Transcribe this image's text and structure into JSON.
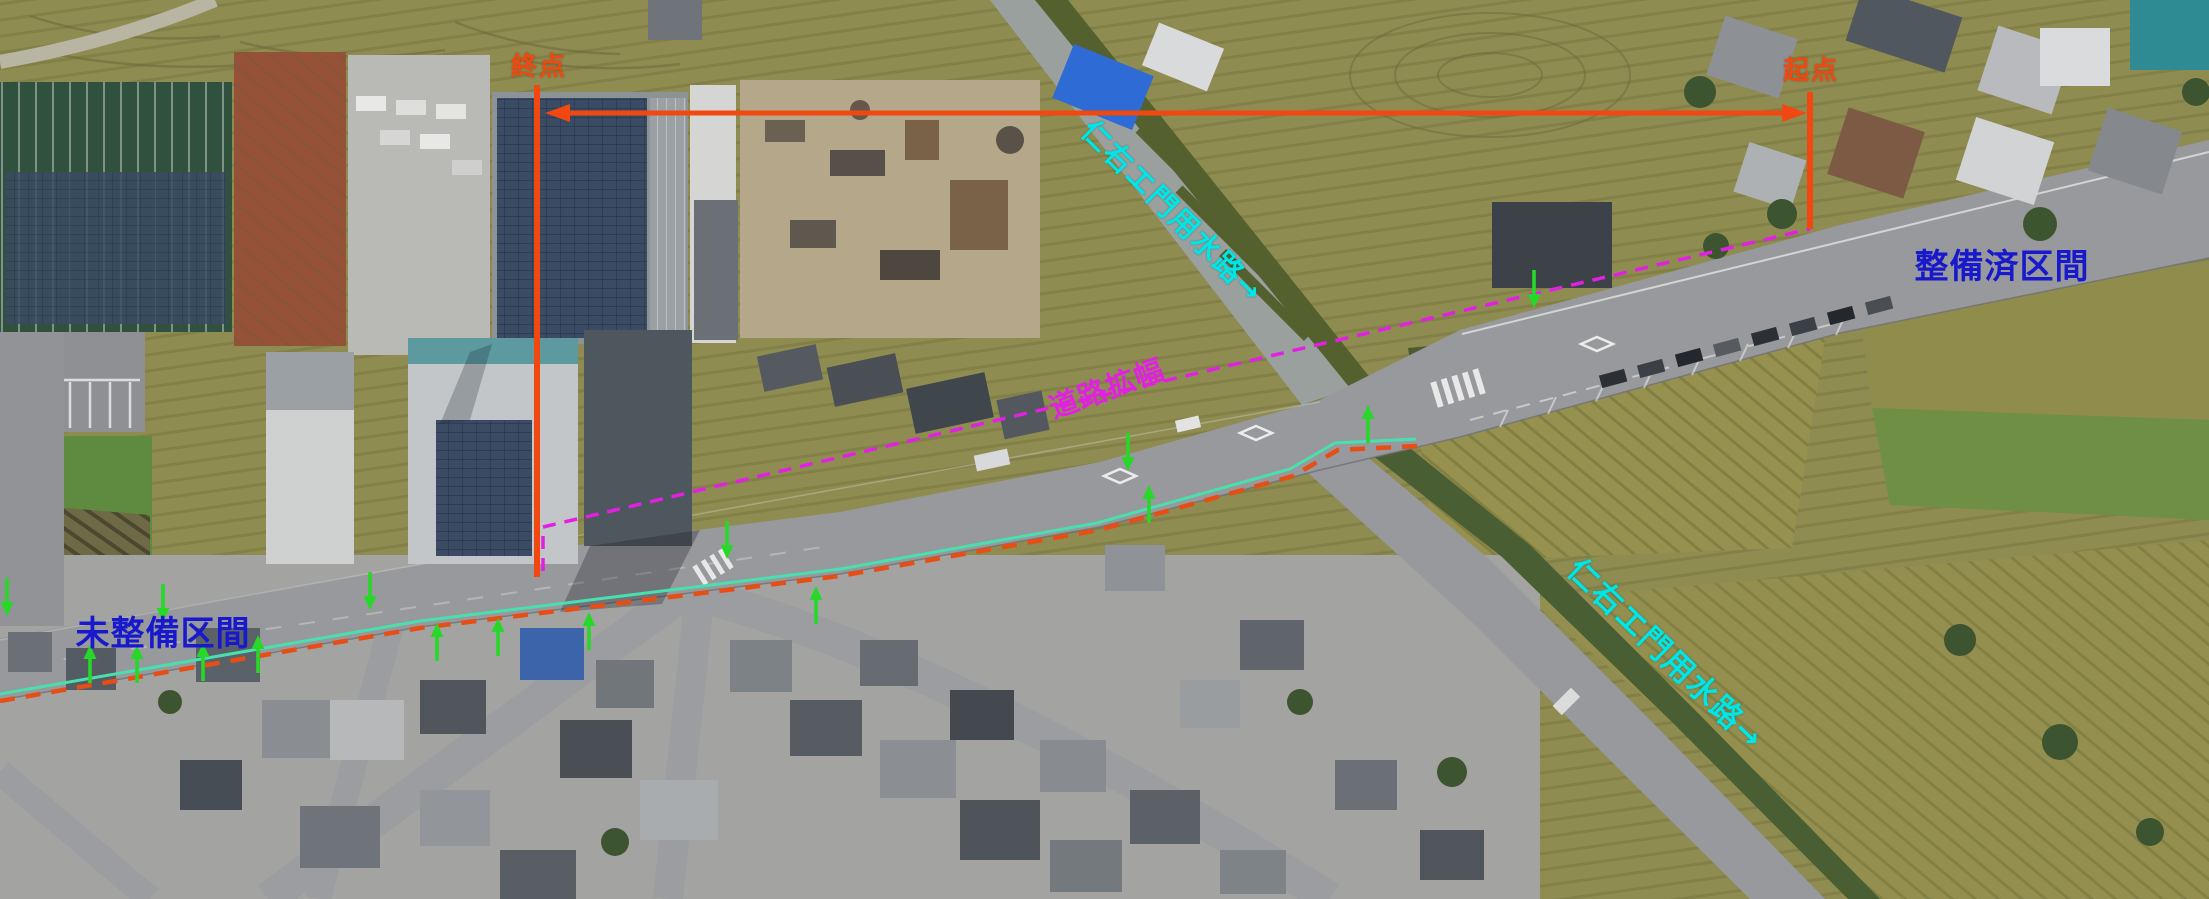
{
  "canvas": {
    "width": 2209,
    "height": 899
  },
  "annotations": {
    "end_point_label": "終点",
    "start_point_label": "起点",
    "upper_waterway_label": "仁右エ門用水路→",
    "lower_waterway_label": "仁右エ門用水路→",
    "improved_section_label": "整備済区間",
    "unimproved_section_label": "未整備区間",
    "road_widening_label": "道路拡幅"
  },
  "colors": {
    "section_marker_orange": "#f04810",
    "widening_magenta": "#e220e2",
    "waterway_cyan": "#00e6e6",
    "section_text_blue": "#1818cc",
    "arrow_green": "#28d828",
    "boundary_teal": "#4ae0ae",
    "boundary_red_dash": "#e64e16"
  },
  "markers": {
    "green_arrows_down": [
      [
        7,
        578
      ],
      [
        163,
        584
      ],
      [
        370,
        572
      ],
      [
        727,
        521
      ],
      [
        1128,
        433
      ],
      [
        1534,
        270
      ]
    ],
    "green_arrows_up": [
      [
        90,
        683
      ],
      [
        137,
        683
      ],
      [
        203,
        681
      ],
      [
        258,
        673
      ],
      [
        437,
        661
      ],
      [
        498,
        656
      ],
      [
        589,
        650
      ],
      [
        816,
        624
      ],
      [
        1149,
        523
      ],
      [
        1368,
        443
      ]
    ]
  }
}
